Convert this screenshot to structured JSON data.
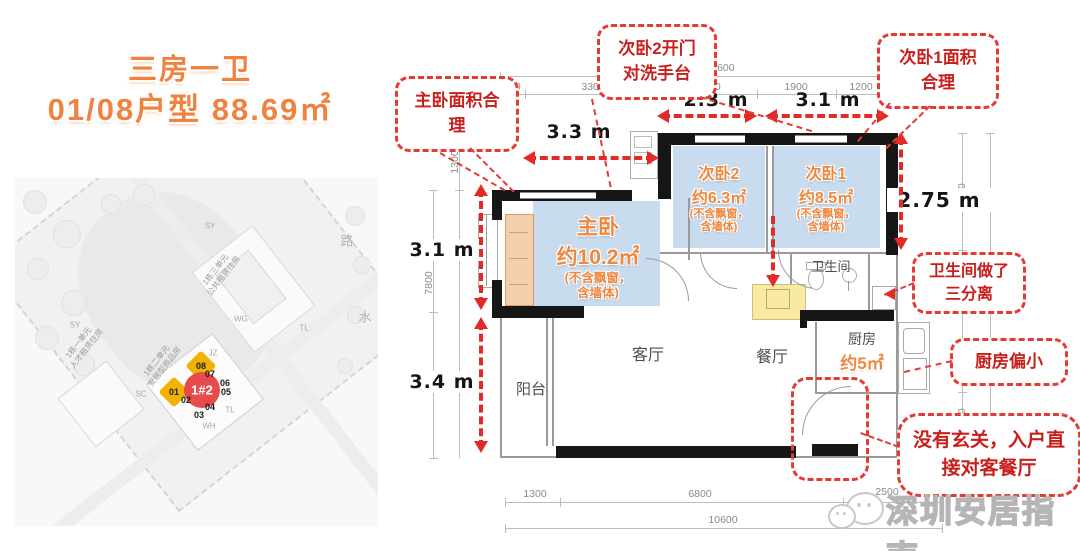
{
  "title": {
    "line1": "三房一卫",
    "line2": "01/08户型 88.69㎡"
  },
  "callouts": {
    "master": "主卧面积合\n理",
    "bed2_door": "次卧2开门\n对洗手台",
    "bed1": "次卧1面积\n合理",
    "bathroom": "卫生间做了\n三分离",
    "kitchen": "厨房偏小",
    "entry": "没有玄关，入户直\n接对客餐厅"
  },
  "rooms": {
    "master": {
      "name": "主卧",
      "area": "约10.2㎡",
      "note": "(不含飘窗，\n含墙体)"
    },
    "bed2": {
      "name": "次卧2",
      "area": "约6.3㎡",
      "note": "(不含飘窗，\n含墙体)"
    },
    "bed1": {
      "name": "次卧1",
      "area": "约8.5㎡",
      "note": "(不含飘窗，\n含墙体)"
    },
    "living": "客厅",
    "dining": "餐厅",
    "balcony": "阳台",
    "bathroom": "卫生间",
    "kitchen": "厨房",
    "kitchen_area": "约5㎡"
  },
  "meter_labels": {
    "top_master": "3.3 m",
    "top_bed2": "2.3 m",
    "top_bed1": "3.1 m",
    "right_bed1": "2.75 m",
    "left_master": "3.1 m",
    "left_balcony": "3.4 m"
  },
  "dims": {
    "top_total": "10600",
    "top_segments": [
      "600",
      "3300",
      "2300",
      "1900",
      "1200",
      "1300"
    ],
    "left_top": "1300",
    "left_outer": "7800",
    "right_segments": [
      "2750",
      "1700"
    ],
    "right_outer": "7800",
    "bottom_segments": [
      "1300",
      "6800",
      "2500"
    ],
    "bottom_total": "10600"
  },
  "map": {
    "unit_highlight": "1#2",
    "unit_08": "08",
    "unit_01": "01",
    "units": [
      "07",
      "06",
      "05",
      "02",
      "04",
      "03"
    ],
    "buildings": {
      "b1": "1栋一单元\n人才租赁住房",
      "b2": "1栋二单元\n安居型商品房",
      "b3": "1栋三单元\n公共租赁住房"
    },
    "labels": [
      "SY",
      "路",
      "水",
      "WG",
      "TL",
      "SY",
      "JZ",
      "SC",
      "TL",
      "WH"
    ]
  },
  "watermark": "深圳安居指南",
  "colors": {
    "accent_red": "#d4302d",
    "room_orange": "#f0873f",
    "overlay_blue": "#c7dbee",
    "unit_yellow": "#f2b200",
    "unit_red": "#e84b4b"
  }
}
